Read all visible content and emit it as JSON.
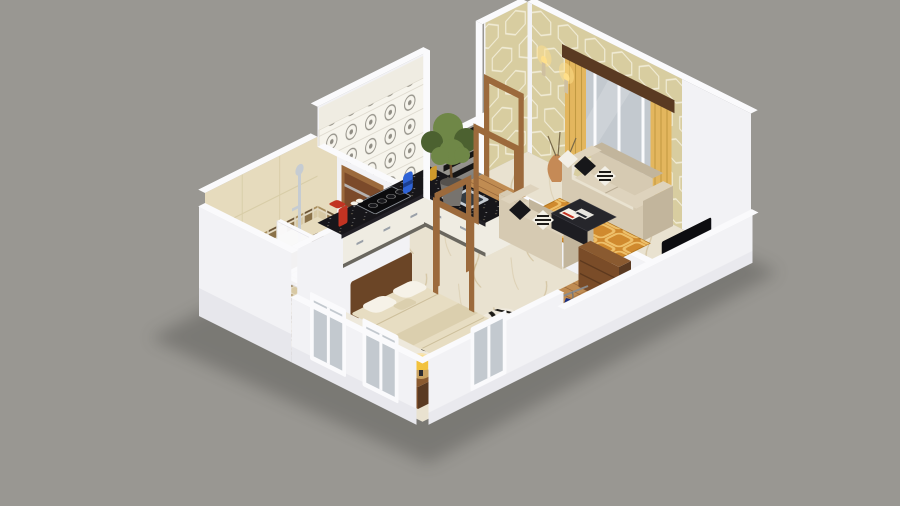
{
  "scene": {
    "kind": "isometric 3d cutaway floor plan render, one-bedroom apartment",
    "rooms": [
      {
        "name": "kitchen",
        "items": [
          "L-shaped black granite counter",
          "white base cabinets",
          "patterned backsplash panels",
          "gas cooktop",
          "steel sink",
          "red mixer",
          "blue canister",
          "gold jar"
        ]
      },
      {
        "name": "balcony",
        "items": [
          "wooden deck",
          "black slat railing",
          "potted plant",
          "wooden door frame"
        ]
      },
      {
        "name": "living-room",
        "items": [
          "hexagon pattern accent wall",
          "gold curtains with dark wood valance",
          "wall sconces",
          "two beige sofas",
          "black and striped cushions",
          "dark coffee table with magazines",
          "orange patterned rug",
          "flat TV",
          "wooden media console",
          "floor vases"
        ]
      },
      {
        "name": "bathroom",
        "items": [
          "beige wall tiles with mosaic border",
          "chrome shower",
          "white shower screen",
          "toilet",
          "mosaic checker floor",
          "wooden door"
        ]
      },
      {
        "name": "bedroom",
        "items": [
          "double bed with cream duvet",
          "white pillows",
          "wood headboard",
          "two nightstands with glowing lamps",
          "zebra print rug",
          "white framed windows"
        ]
      },
      {
        "name": "wardrobe-nook",
        "items": [
          "wooden dresser",
          "clothes rail with blue clothes",
          "plank wood floor"
        ]
      }
    ]
  },
  "colors": {
    "background": "#999792",
    "shadow": "#3a3a38",
    "wall_face": "#f2f2f5",
    "wall_top": "#fafafc",
    "wall_shade": "#d9d9e2",
    "marble_floor": "#e9e2d0",
    "marble_vein": "#c3ad7e",
    "wood_floor": "#c08c52",
    "plank_line": "#7a4c28",
    "door_wood": "#7b4a2a",
    "frame_wood": "#9c6a3c",
    "counter_granite": "#17161a",
    "cabinet_white": "#efece2",
    "backsplash": "#f6f4ec",
    "backsplash_motif": "#908d84",
    "steel": "#c6ccd2",
    "hex_wall": "#d8cda0",
    "hex_line": "#f1ecd6",
    "curtain_gold": "#e3b65e",
    "valance_wood": "#5a3a22",
    "window_glass": "#c3c9cf",
    "sofa_body": "#d6cab2",
    "sofa_seat": "#ded3bd",
    "sofa_shade": "#c2b59c",
    "pillow_dark": "#17171a",
    "pillow_light": "#f2efe6",
    "rug_orange": "#d08a2e",
    "rug_motif": "#eec06a",
    "coffee_table": "#26262b",
    "tv_screen": "#0d0d10",
    "console_wood": "#8a5a30",
    "tile_beige": "#e6dbbd",
    "tile_dark": "#53412c",
    "mosaic_a": "#a98f5e",
    "mosaic_b": "#6b5436",
    "mosaic_c": "#d8c9a4",
    "mosaic_d": "#8a7148",
    "grout": "#e3d9c0",
    "sanitary_white": "#f7f6f4",
    "bed_spread": "#e7ddc2",
    "bed_runner": "#dbcfae",
    "bed_side": "#eee9dc",
    "headboard_wood": "#6b4526",
    "pillow_white": "#f6f2e8",
    "zebra_base": "#efe9dc",
    "zebra_stripe": "#1c1a17",
    "lamp_shade": "#f2c23e",
    "lamp_glow": "#ffdf8a",
    "plant_green": "#6f8747",
    "plant_dark": "#4c6130",
    "pot_gray": "#77736e",
    "rail_dark": "#151515",
    "appliance_red": "#c23322",
    "jar_blue": "#2f63d6",
    "jar_gold": "#cf9a2c",
    "clothes_navy": "#1a2f80"
  }
}
